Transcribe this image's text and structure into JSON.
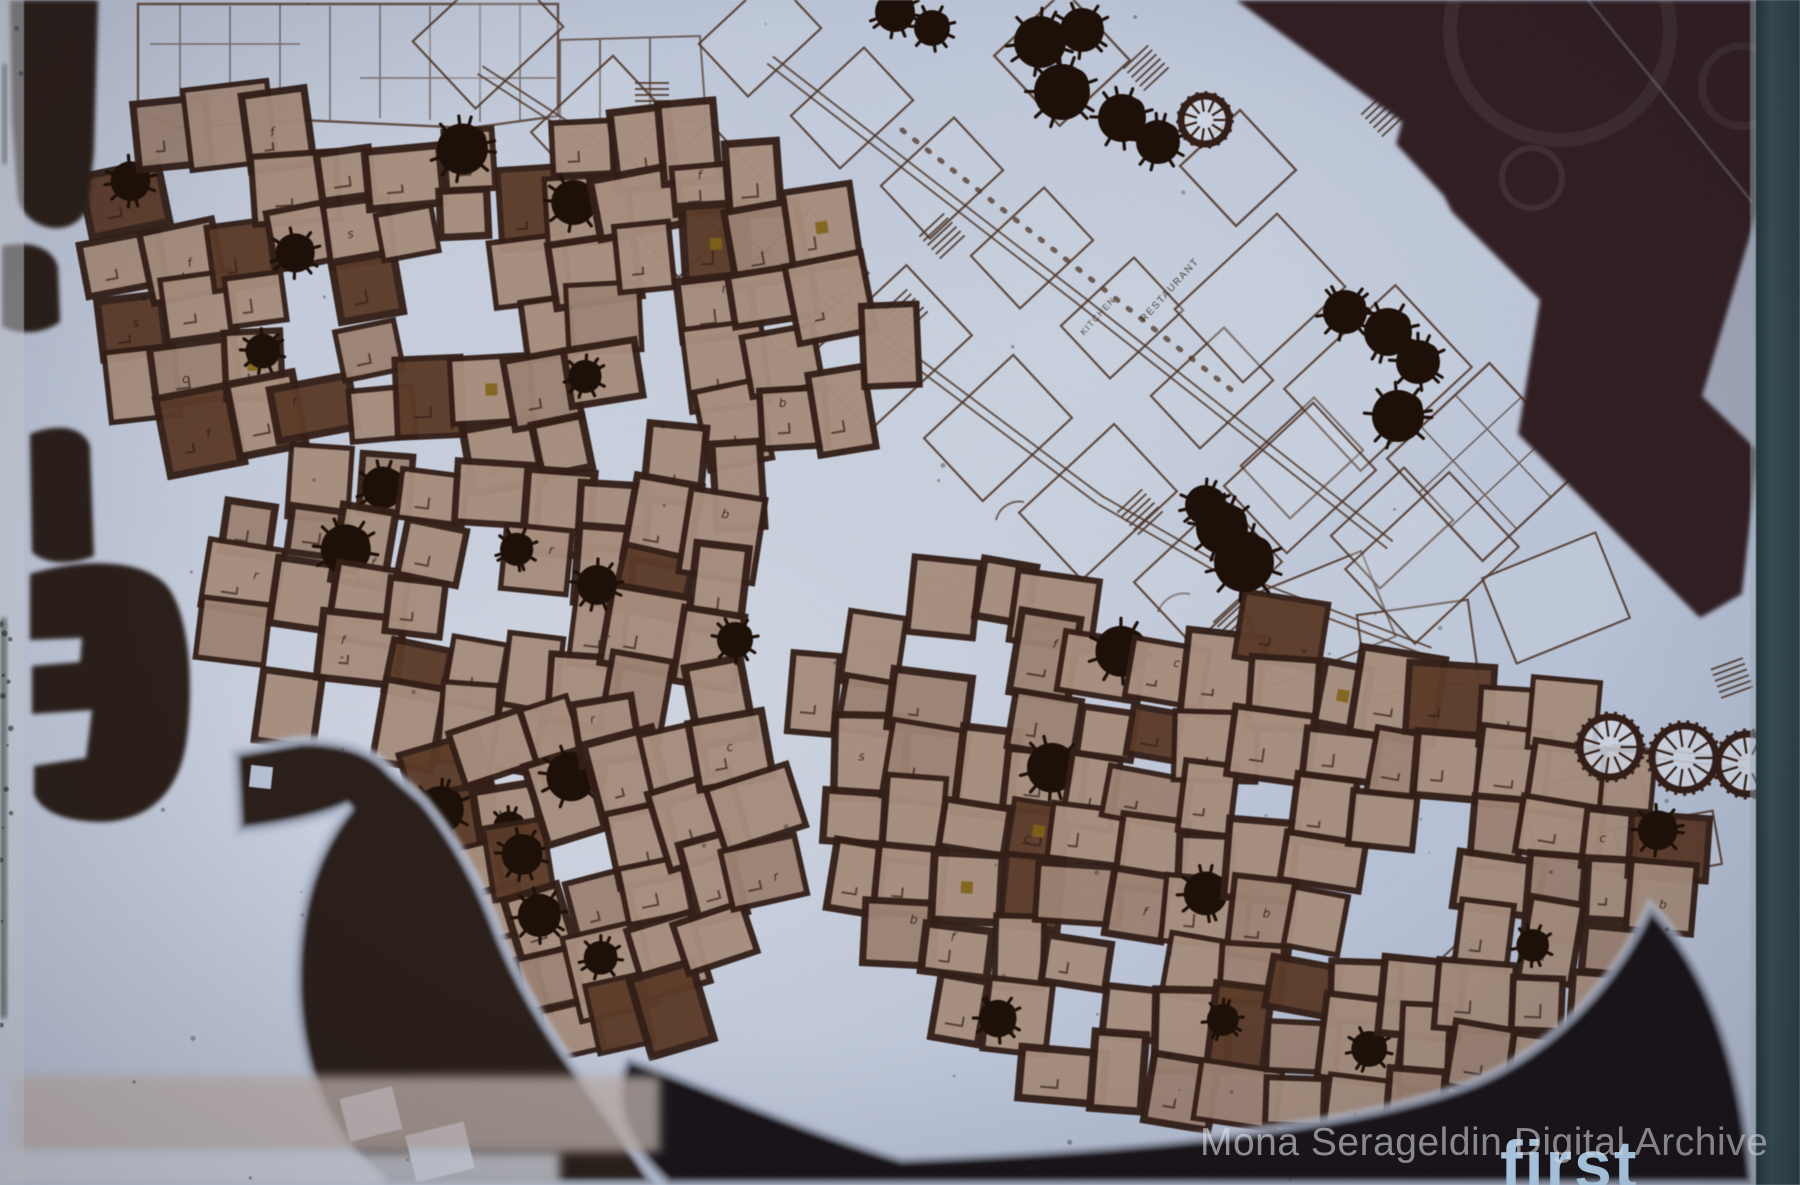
{
  "watermark": "Mona Serageldin Digital Archive",
  "plan_caption_fragment": "first",
  "labels": {
    "restaurant": "RESTAURANT",
    "kitchen": "KITCHEN"
  },
  "palette": {
    "bg": "#c4cfe5",
    "bg2": "#e7ecf5",
    "paper": "#d8dfee",
    "road": "#2f211e",
    "mass": "#362227",
    "wedge": "#2e1e20",
    "band": "#1a141a",
    "teal": "#31454b",
    "teal2": "#3e565d",
    "seam": "#a8bcc6",
    "pink": "#c9bcb6",
    "pale": "#d9dde6",
    "unit": "#b39887",
    "unit2": "#a88c7c",
    "unitdark": "#63402c",
    "wall": "#38221a",
    "outline": "#54392a",
    "tree": "#201209",
    "ochre": "#8a6a1a",
    "letter": "#2e1c12",
    "label": "#33261c",
    "first": "#b7d7f1"
  },
  "plan": {
    "unit_letters": [
      "c",
      "r",
      "b",
      "s",
      "f"
    ],
    "clusters": [
      {
        "name": "northwest-housing-cluster",
        "seed": 11,
        "rot": -7,
        "step": 58,
        "poly": [
          [
            96,
            212
          ],
          [
            150,
            138
          ],
          [
            262,
            114
          ],
          [
            420,
            140
          ],
          [
            545,
            118
          ],
          [
            648,
            150
          ],
          [
            724,
            128
          ],
          [
            850,
            255
          ],
          [
            902,
            330
          ],
          [
            884,
            470
          ],
          [
            800,
            452
          ],
          [
            756,
            492
          ],
          [
            688,
            470
          ],
          [
            560,
            486
          ],
          [
            430,
            452
          ],
          [
            300,
            462
          ],
          [
            205,
            440
          ],
          [
            120,
            418
          ],
          [
            88,
            330
          ]
        ],
        "voids": [
          [
            448,
            310,
            90,
            110
          ],
          [
            250,
            190,
            70,
            70
          ],
          [
            640,
            400,
            70,
            80
          ],
          [
            330,
            330,
            60,
            60
          ]
        ]
      },
      {
        "name": "midwest-housing-cluster",
        "seed": 22,
        "rot": 8,
        "step": 58,
        "poly": [
          [
            205,
            565
          ],
          [
            298,
            482
          ],
          [
            425,
            452
          ],
          [
            558,
            470
          ],
          [
            672,
            452
          ],
          [
            758,
            518
          ],
          [
            742,
            632
          ],
          [
            678,
            696
          ],
          [
            606,
            742
          ],
          [
            536,
            788
          ],
          [
            466,
            768
          ],
          [
            398,
            744
          ],
          [
            308,
            758
          ],
          [
            238,
            688
          ],
          [
            198,
            624
          ]
        ],
        "voids": [
          [
            480,
            580,
            70,
            120
          ],
          [
            300,
            640,
            60,
            70
          ]
        ]
      },
      {
        "name": "southcenter-housing-cluster",
        "seed": 33,
        "rot": -14,
        "step": 58,
        "poly": [
          [
            452,
            738
          ],
          [
            560,
            692
          ],
          [
            650,
            702
          ],
          [
            744,
            682
          ],
          [
            802,
            742
          ],
          [
            792,
            852
          ],
          [
            734,
            952
          ],
          [
            658,
            1042
          ],
          [
            578,
            1072
          ],
          [
            498,
            1018
          ],
          [
            448,
            928
          ],
          [
            426,
            828
          ]
        ],
        "voids": [
          [
            600,
            850,
            70,
            80
          ]
        ]
      },
      {
        "name": "southeast-housing-cluster",
        "seed": 44,
        "rot": 6,
        "step": 58,
        "poly": [
          [
            812,
            692
          ],
          [
            900,
            622
          ],
          [
            962,
            582
          ],
          [
            1082,
            602
          ],
          [
            1182,
            642
          ],
          [
            1302,
            622
          ],
          [
            1422,
            682
          ],
          [
            1542,
            702
          ],
          [
            1652,
            762
          ],
          [
            1712,
            842
          ],
          [
            1662,
            942
          ],
          [
            1592,
            1022
          ],
          [
            1522,
            1092
          ],
          [
            1422,
            1122
          ],
          [
            1302,
            1132
          ],
          [
            1152,
            1122
          ],
          [
            1032,
            1082
          ],
          [
            932,
            1002
          ],
          [
            862,
            902
          ],
          [
            822,
            782
          ]
        ],
        "voids": [
          [
            1262,
            802,
            90,
            90
          ],
          [
            1002,
            682,
            70,
            90
          ],
          [
            1142,
            962,
            80,
            70
          ],
          [
            1400,
            900,
            80,
            80
          ]
        ]
      }
    ],
    "trees": [
      [
        895,
        12,
        20
      ],
      [
        932,
        28,
        18
      ],
      [
        1040,
        42,
        26
      ],
      [
        1082,
        30,
        22
      ],
      [
        1062,
        92,
        28
      ],
      [
        1122,
        118,
        24
      ],
      [
        1158,
        142,
        22
      ],
      [
        1345,
        312,
        22
      ],
      [
        1388,
        332,
        24
      ],
      [
        1418,
        362,
        22
      ],
      [
        1398,
        416,
        26
      ],
      [
        1222,
        528,
        26
      ],
      [
        1244,
        562,
        30
      ],
      [
        1205,
        505,
        20
      ],
      [
        597,
        585,
        20
      ],
      [
        735,
        640,
        18
      ]
    ],
    "ring_trees": [
      [
        1205,
        120,
        24
      ],
      [
        1610,
        747,
        30
      ],
      [
        1684,
        758,
        32
      ],
      [
        1748,
        764,
        30
      ]
    ],
    "outline_rooms": [
      [
        488,
        34,
        120,
        92,
        -43
      ],
      [
        600,
        124,
        112,
        82,
        -43
      ],
      [
        694,
        200,
        128,
        92,
        -43
      ],
      [
        796,
        282,
        118,
        86,
        -43
      ],
      [
        888,
        348,
        140,
        96,
        -43
      ],
      [
        998,
        428,
        122,
        86,
        -43
      ],
      [
        1098,
        502,
        130,
        92,
        -43
      ],
      [
        1208,
        572,
        122,
        86,
        -43
      ],
      [
        1318,
        618,
        130,
        92,
        -22
      ],
      [
        1418,
        648,
        112,
        82,
        -8
      ],
      [
        760,
        36,
        100,
        72,
        -43
      ],
      [
        852,
        108,
        100,
        72,
        -43
      ],
      [
        942,
        178,
        100,
        72,
        -43
      ],
      [
        1032,
        248,
        100,
        72,
        -43
      ],
      [
        1122,
        318,
        100,
        72,
        -43
      ],
      [
        1212,
        388,
        100,
        72,
        -43
      ],
      [
        1302,
        458,
        100,
        72,
        -43
      ],
      [
        1392,
        528,
        100,
        72,
        -43
      ],
      [
        1260,
        298,
        140,
        100,
        -43
      ],
      [
        1378,
        378,
        152,
        112,
        -43
      ],
      [
        1300,
        478,
        122,
        92,
        -43
      ],
      [
        1432,
        558,
        142,
        102,
        -43
      ],
      [
        1556,
        598,
        122,
        92,
        -22
      ],
      [
        1586,
        806,
        120,
        60,
        -14
      ],
      [
        1668,
        846,
        100,
        54,
        -10
      ]
    ],
    "corridors": [
      [
        480,
        70,
        700,
        212
      ],
      [
        700,
        212,
        900,
        350
      ],
      [
        900,
        350,
        1100,
        500
      ],
      [
        1100,
        500,
        1240,
        580
      ],
      [
        1240,
        580,
        1430,
        652
      ],
      [
        770,
        60,
        1080,
        300
      ],
      [
        1080,
        300,
        1390,
        545
      ],
      [
        1612,
        749,
        1746,
        764
      ]
    ],
    "dotted": [
      [
        902,
        130,
        1234,
        392
      ]
    ],
    "courts": [
      [
        1062,
        58,
        96,
        -43
      ],
      [
        1238,
        168,
        82,
        -43
      ],
      [
        1486,
        462,
        140,
        -43
      ]
    ],
    "hatches": [
      [
        1146,
        68,
        -43
      ],
      [
        1140,
        512,
        -43
      ],
      [
        1236,
        622,
        -43
      ],
      [
        1384,
        114,
        -43
      ],
      [
        1732,
        678,
        -20
      ],
      [
        1466,
        956,
        -43
      ],
      [
        942,
        236,
        -43
      ],
      [
        652,
        98,
        0
      ],
      [
        905,
        312,
        -43
      ]
    ]
  }
}
